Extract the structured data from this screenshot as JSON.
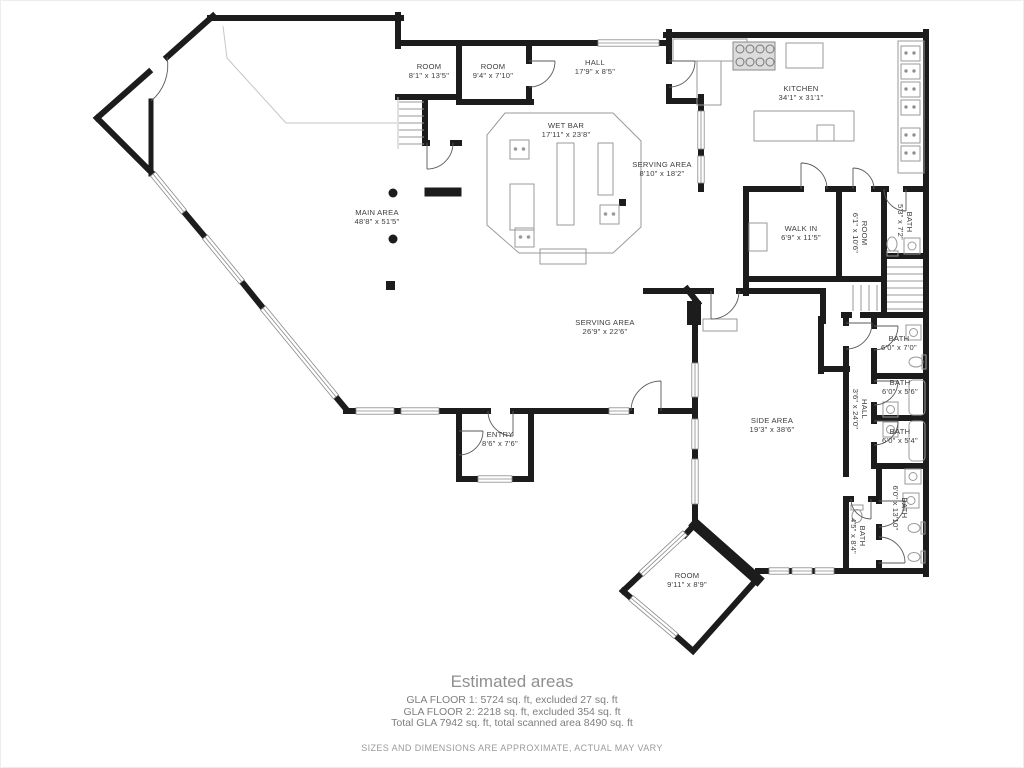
{
  "colors": {
    "wall": "#1c1c1c",
    "fixture": "#9a9a9a",
    "window_frame": "#8a8a8a",
    "door_arc": "#5a5a5a",
    "label_text": "#3d3d3d",
    "footer_text": "#8c8c8c"
  },
  "floor_plan": {
    "rooms": [
      {
        "id": "room-1",
        "name": "ROOM",
        "dims": "8'1\" x 13'5\"",
        "x": 428,
        "y": 68,
        "rotate": 0
      },
      {
        "id": "room-2",
        "name": "ROOM",
        "dims": "9'4\" x 7'10\"",
        "x": 492,
        "y": 68,
        "rotate": 0
      },
      {
        "id": "hall-top",
        "name": "HALL",
        "dims": "17'9\" x 8'5\"",
        "x": 594,
        "y": 64,
        "rotate": 0
      },
      {
        "id": "kitchen",
        "name": "KITCHEN",
        "dims": "34'1\" x 31'1\"",
        "x": 800,
        "y": 90,
        "rotate": 0
      },
      {
        "id": "wet-bar",
        "name": "WET BAR",
        "dims": "17'11\" x 23'8\"",
        "x": 565,
        "y": 127,
        "rotate": 0
      },
      {
        "id": "serving-area-1",
        "name": "SERVING AREA",
        "dims": "8'10\" x 18'2\"",
        "x": 661,
        "y": 166,
        "rotate": 0
      },
      {
        "id": "main-area",
        "name": "MAIN AREA",
        "dims": "48'8\" x 51'5\"",
        "x": 376,
        "y": 214,
        "rotate": 0
      },
      {
        "id": "walk-in",
        "name": "WALK IN",
        "dims": "6'9\" x 11'5\"",
        "x": 800,
        "y": 230,
        "rotate": 0
      },
      {
        "id": "room-3",
        "name": "ROOM",
        "dims": "6'1\" x 10'6\"",
        "x": 861,
        "y": 232,
        "rotate": 90
      },
      {
        "id": "bath-1",
        "name": "BATH",
        "dims": "5'3\" x 7'2\"",
        "x": 906,
        "y": 221,
        "rotate": 90
      },
      {
        "id": "serving-area-2",
        "name": "SERVING AREA",
        "dims": "26'9\" x 22'6\"",
        "x": 604,
        "y": 324,
        "rotate": 0
      },
      {
        "id": "bath-2",
        "name": "BATH",
        "dims": "6'0\" x 7'0\"",
        "x": 898,
        "y": 340,
        "rotate": 0
      },
      {
        "id": "bath-3",
        "name": "BATH",
        "dims": "6'0\" x 5'6\"",
        "x": 899,
        "y": 384,
        "rotate": 0
      },
      {
        "id": "hall-side",
        "name": "HALL",
        "dims": "3'6\" x 24'0\"",
        "x": 861,
        "y": 408,
        "rotate": 90
      },
      {
        "id": "bath-4",
        "name": "BATH",
        "dims": "6'0\" x 5'4\"",
        "x": 899,
        "y": 433,
        "rotate": 0
      },
      {
        "id": "side-area",
        "name": "SIDE AREA",
        "dims": "19'3\" x 38'6\"",
        "x": 771,
        "y": 422,
        "rotate": 0
      },
      {
        "id": "bath-5",
        "name": "BATH",
        "dims": "6'0\" x 13'10\"",
        "x": 901,
        "y": 507,
        "rotate": 90
      },
      {
        "id": "bath-6",
        "name": "BATH",
        "dims": "4'5\" x 8'4\"",
        "x": 859,
        "y": 535,
        "rotate": 90
      },
      {
        "id": "entry",
        "name": "ENTRY",
        "dims": "8'6\" x 7'6\"",
        "x": 499,
        "y": 436,
        "rotate": 0
      },
      {
        "id": "room-4",
        "name": "ROOM",
        "dims": "9'11\" x 8'9\"",
        "x": 686,
        "y": 577,
        "rotate": 0
      }
    ]
  },
  "footer": {
    "title": "Estimated areas",
    "lines": [
      "GLA FLOOR 1: 5724 sq. ft, excluded 27 sq. ft",
      "GLA FLOOR 2: 2218 sq. ft, excluded 354 sq. ft",
      "Total GLA 7942 sq. ft, total scanned area 8490 sq. ft"
    ],
    "disclaimer": "SIZES AND DIMENSIONS ARE APPROXIMATE, ACTUAL MAY VARY"
  }
}
